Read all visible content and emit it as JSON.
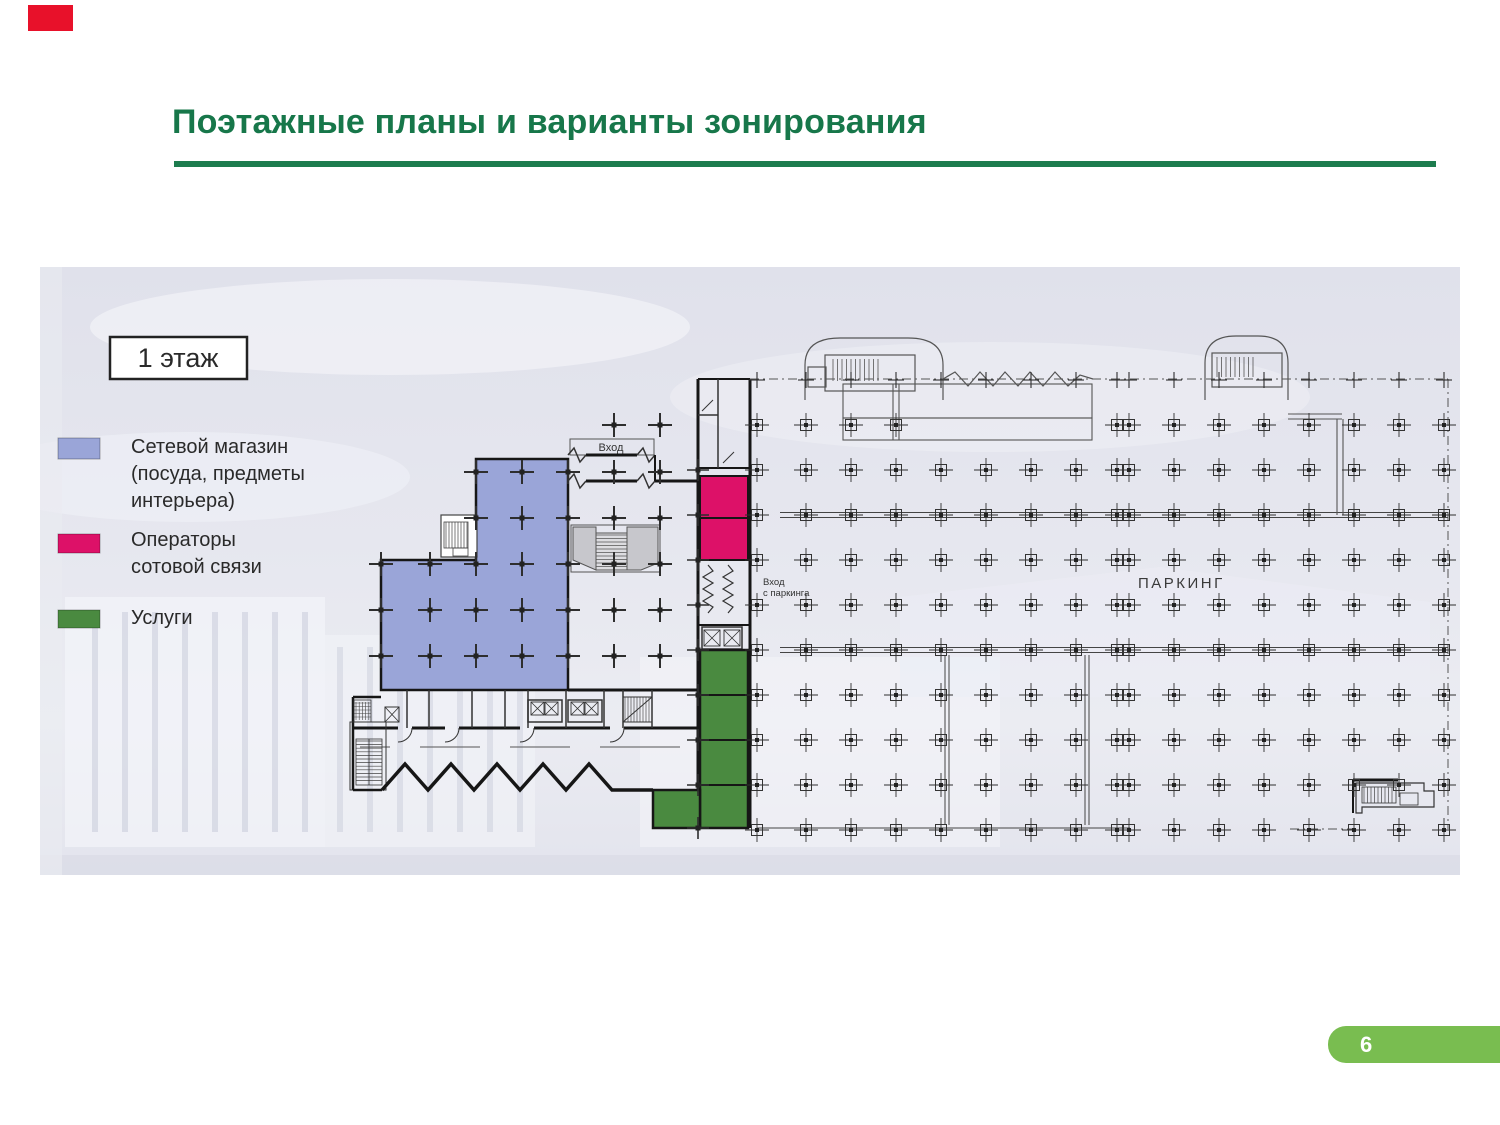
{
  "slide": {
    "title": "Поэтажные планы и варианты зонирования",
    "page_number": "6"
  },
  "plan": {
    "floor_label": "1 этаж",
    "legend": [
      {
        "label_lines": [
          "Сетевой магазин",
          "(посуда, предметы",
          "интерьера)"
        ],
        "color": "#9aa5d8"
      },
      {
        "label_lines": [
          "Операторы",
          "сотовой связи"
        ],
        "color": "#dd1168"
      },
      {
        "label_lines": [
          "Услуги"
        ],
        "color": "#4a8a40"
      }
    ],
    "labels": {
      "entrance": "Вход",
      "entrance_from_parking_line1": "Вход",
      "entrance_from_parking_line2": "с паркинга",
      "parking": "ПАРКИНГ"
    }
  },
  "colors": {
    "title_green": "#17774a",
    "underline_green": "#1d7c4e",
    "badge_green": "#79bd50",
    "corner_red": "#e8112a",
    "zone_store_blue": "#9aa5d8",
    "zone_mobile_pink": "#dd1168",
    "zone_services_green": "#4a8a40"
  }
}
